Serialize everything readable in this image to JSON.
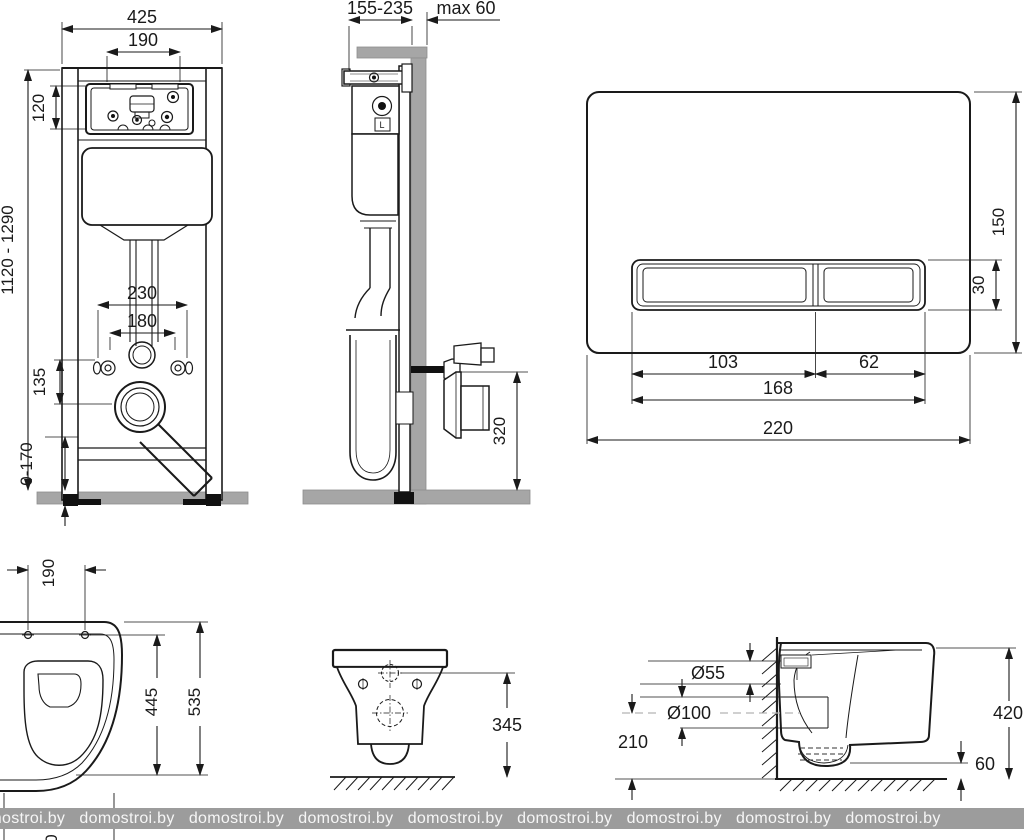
{
  "watermark": {
    "text": "domostroi.by",
    "repeat_count": 9,
    "band_color": "#9c9c9c"
  },
  "colors": {
    "line": "#1a1a1a",
    "gray_fill": "#a6a6a6",
    "centerline_gray": "#b5b5b5"
  },
  "views": {
    "frame_front": {
      "total_width": "425",
      "access_width": "190",
      "access_height": "120",
      "height_range": "1120 - 1290",
      "rod_spacing": "230",
      "inner_spacing": "180",
      "outlet_offset": "135",
      "foot_range": "0-170"
    },
    "frame_side": {
      "depth_range": "155-235",
      "wall_max": "max 60",
      "outlet_height": "320",
      "tank_label": "L"
    },
    "flush_plate": {
      "height": "150",
      "button_height": "30",
      "big_button_width": "103",
      "small_button_width": "62",
      "buttons_total_width": "168",
      "total_width": "220"
    },
    "bowl_top": {
      "hole_spacing": "190",
      "inner_depth": "445",
      "total_depth": "535",
      "partial_label": "0"
    },
    "bowl_rear": {
      "mount_height": "345"
    },
    "bowl_side": {
      "inlet_diameter": "Ø55",
      "outlet_diameter": "Ø100",
      "outlet_center_height": "210",
      "bowl_height": "420",
      "bottom_clearance": "60"
    }
  }
}
